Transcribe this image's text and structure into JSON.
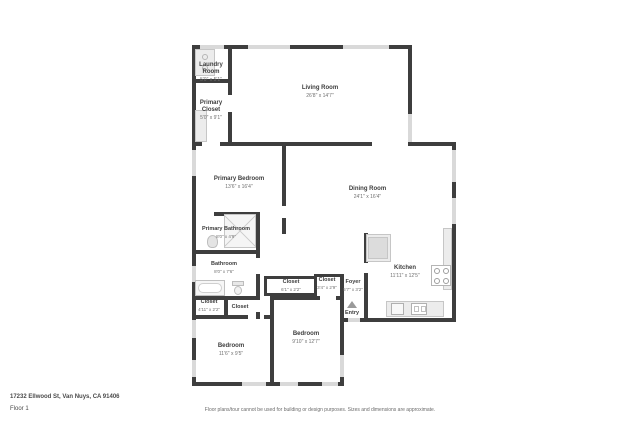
{
  "rooms": {
    "laundry": {
      "name": "Laundry Room",
      "dims": "5'0\" x 5'1\""
    },
    "primary_closet": {
      "name": "Primary Closet",
      "dims": "5'0\" x 9'1\""
    },
    "living": {
      "name": "Living Room",
      "dims": "26'8\" x 14'7\""
    },
    "primary_bedroom": {
      "name": "Primary Bedroom",
      "dims": "13'6\" x 16'4\""
    },
    "dining": {
      "name": "Dining Room",
      "dims": "24'1\" x 16'4\""
    },
    "primary_bathroom": {
      "name": "Primary Bathroom",
      "dims": "8'0\" x 4'9\""
    },
    "bathroom": {
      "name": "Bathroom",
      "dims": "8'0\" x 7'6\""
    },
    "kitchen": {
      "name": "Kitchen",
      "dims": "11'11\" x 12'5\""
    },
    "closet_hall_left": {
      "name": "Closet",
      "dims": "4'11\" x 2'2\""
    },
    "closet_hall_small": {
      "name": "Closet",
      "dims": ""
    },
    "closet_center": {
      "name": "Closet",
      "dims": "6'1\" x 2'2\""
    },
    "closet_entry": {
      "name": "Closet",
      "dims": "3'4\" x 2'9\""
    },
    "foyer": {
      "name": "Foyer",
      "dims": "5'7\" x 3'2\""
    },
    "bedroom_left": {
      "name": "Bedroom",
      "dims": "11'6\" x 9'5\""
    },
    "bedroom_right": {
      "name": "Bedroom",
      "dims": "9'10\" x 12'7\""
    }
  },
  "entry": {
    "label": "Entry"
  },
  "footer": {
    "address": "17232 Ellwood St, Van Nuys, CA 91406",
    "floor": "Floor 1",
    "disclaimer": "Floor plans/tour cannot be used for building or design purposes. Sizes and dimensions are approximate."
  },
  "colors": {
    "wall": "#3e3e3e",
    "window": "#d9d9d9",
    "fixture": "#ececec"
  }
}
